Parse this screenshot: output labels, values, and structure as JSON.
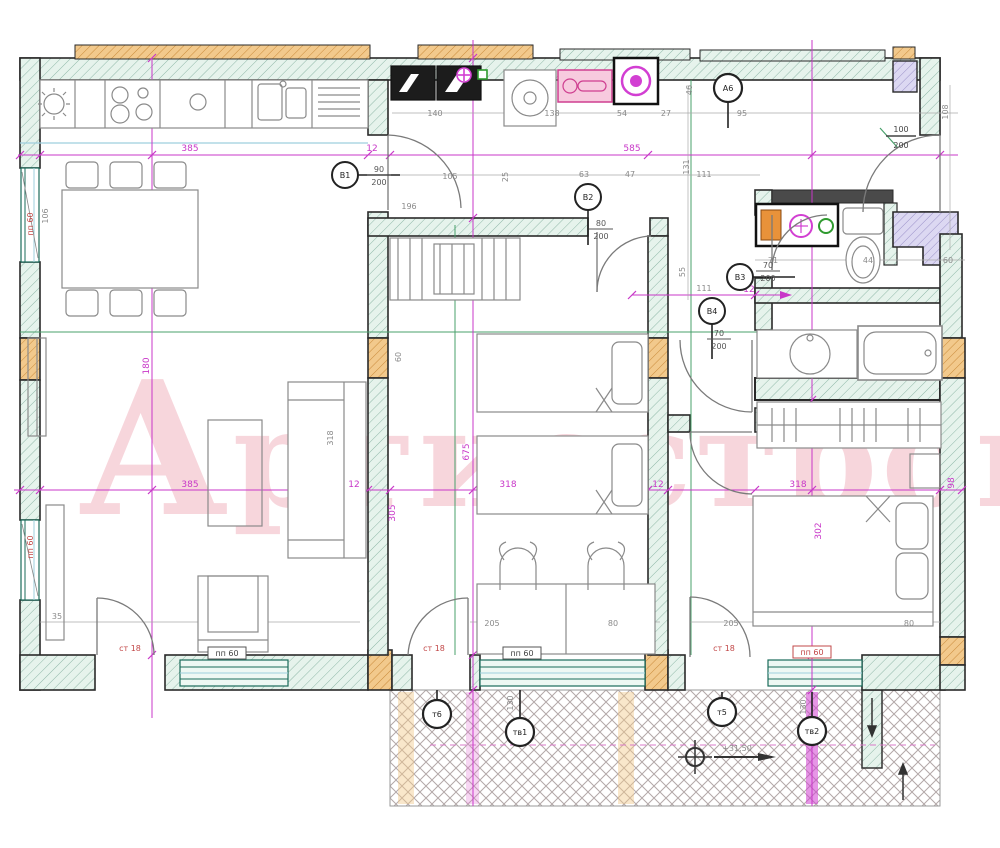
{
  "meta": {
    "drawing_type": "apartment floor plan",
    "style": "CAD blueprint with axis grid"
  },
  "watermark": {
    "first": "А",
    "rest": "ртисстрой",
    "color": "#e8889c"
  },
  "colors": {
    "axis_magenta": "#c837c8",
    "wall_teal": "#e6f3ec",
    "hatch_teal": "#8fb8a8",
    "column_orange": "#f2c98c",
    "corner_lavender": "#dcd8f2",
    "guide_green": "#49a06b",
    "guide_cyan": "#9ecfdd",
    "fixture_orange": "#e8923a",
    "fixture_green": "#2f9a2f",
    "appliance_pink": "#f7cade"
  },
  "dims": [
    {
      "t": "140",
      "x": 435,
      "y": 116,
      "c": "dim"
    },
    {
      "t": "138",
      "x": 552,
      "y": 116,
      "c": "dim"
    },
    {
      "t": "54",
      "x": 622,
      "y": 116,
      "c": "dim"
    },
    {
      "t": "27",
      "x": 666,
      "y": 116,
      "c": "dim"
    },
    {
      "t": "95",
      "x": 742,
      "y": 116,
      "c": "dim"
    },
    {
      "t": "46",
      "x": 692,
      "y": 90,
      "c": "dim",
      "rot": -90
    },
    {
      "t": "108",
      "x": 948,
      "y": 112,
      "c": "dim",
      "rot": -90
    },
    {
      "t": "106",
      "x": 48,
      "y": 216,
      "c": "dim",
      "rot": -90
    },
    {
      "t": "пп 60",
      "x": 33,
      "y": 224,
      "c": "dim-red",
      "rot": -90
    },
    {
      "t": "пп 60",
      "x": 33,
      "y": 547,
      "c": "dim-red",
      "rot": -90
    },
    {
      "t": "105",
      "x": 450,
      "y": 179,
      "c": "dim"
    },
    {
      "t": "25",
      "x": 508,
      "y": 177,
      "c": "dim",
      "rot": -90
    },
    {
      "t": "63",
      "x": 584,
      "y": 177,
      "c": "dim"
    },
    {
      "t": "47",
      "x": 630,
      "y": 177,
      "c": "dim"
    },
    {
      "t": "131",
      "x": 689,
      "y": 167,
      "c": "dim",
      "rot": -90
    },
    {
      "t": "111",
      "x": 704,
      "y": 177,
      "c": "dim"
    },
    {
      "t": "196",
      "x": 409,
      "y": 209,
      "c": "dim"
    },
    {
      "t": "71",
      "x": 773,
      "y": 263,
      "c": "dim"
    },
    {
      "t": "44",
      "x": 868,
      "y": 263,
      "c": "dim"
    },
    {
      "t": "60",
      "x": 948,
      "y": 263,
      "c": "dim"
    },
    {
      "t": "55",
      "x": 685,
      "y": 272,
      "c": "dim",
      "rot": -90
    },
    {
      "t": "111",
      "x": 704,
      "y": 291,
      "c": "dim"
    },
    {
      "t": "60",
      "x": 401,
      "y": 357,
      "c": "dim",
      "rot": -90
    },
    {
      "t": "318",
      "x": 333,
      "y": 438,
      "c": "dim",
      "rot": -90
    },
    {
      "t": "35",
      "x": 57,
      "y": 619,
      "c": "dim"
    },
    {
      "t": "205",
      "x": 492,
      "y": 626,
      "c": "dim"
    },
    {
      "t": "80",
      "x": 613,
      "y": 626,
      "c": "dim"
    },
    {
      "t": "205",
      "x": 731,
      "y": 626,
      "c": "dim"
    },
    {
      "t": "80",
      "x": 909,
      "y": 626,
      "c": "dim"
    },
    {
      "t": "130",
      "x": 513,
      "y": 703,
      "c": "dim",
      "rot": -90
    },
    {
      "t": "130",
      "x": 806,
      "y": 707,
      "c": "dim",
      "rot": -90
    },
    {
      "t": "385",
      "x": 190,
      "y": 151,
      "c": "dim-mag"
    },
    {
      "t": "12",
      "x": 372,
      "y": 151,
      "c": "dim-mag"
    },
    {
      "t": "585",
      "x": 632,
      "y": 151,
      "c": "dim-mag"
    },
    {
      "t": "385",
      "x": 190,
      "y": 487,
      "c": "dim-mag"
    },
    {
      "t": "12",
      "x": 354,
      "y": 487,
      "c": "dim-mag"
    },
    {
      "t": "318",
      "x": 508,
      "y": 487,
      "c": "dim-mag"
    },
    {
      "t": "12",
      "x": 658,
      "y": 487,
      "c": "dim-mag"
    },
    {
      "t": "318",
      "x": 798,
      "y": 487,
      "c": "dim-mag"
    },
    {
      "t": "98",
      "x": 954,
      "y": 483,
      "c": "dim-mag",
      "rot": -90
    },
    {
      "t": "180",
      "x": 149,
      "y": 366,
      "c": "dim-mag",
      "rot": -90
    },
    {
      "t": "675",
      "x": 469,
      "y": 452,
      "c": "dim-mag",
      "rot": -90
    },
    {
      "t": "305",
      "x": 395,
      "y": 513,
      "c": "dim-mag",
      "rot": -90
    },
    {
      "t": "302",
      "x": 821,
      "y": 531,
      "c": "dim-mag",
      "rot": -90
    },
    {
      "t": "12",
      "x": 749,
      "y": 292,
      "c": "dim-mag"
    },
    {
      "t": "ст 18",
      "x": 130,
      "y": 651,
      "c": "dim-red"
    },
    {
      "t": "ст 18",
      "x": 434,
      "y": 651,
      "c": "dim-red"
    },
    {
      "t": "ст 18",
      "x": 724,
      "y": 651,
      "c": "dim-red"
    },
    {
      "t": "пп 60",
      "x": 227,
      "y": 656,
      "c": "dim-dark",
      "box": "dark"
    },
    {
      "t": "пп 60",
      "x": 522,
      "y": 656,
      "c": "dim-dark",
      "box": "dark"
    },
    {
      "t": "пп 60",
      "x": 812,
      "y": 655,
      "c": "dim-red",
      "box": "red"
    }
  ],
  "door_markers": [
    {
      "label": "В1",
      "x": 345,
      "y": 175,
      "num": "90",
      "den": "200",
      "fx": 379,
      "fy": 172,
      "stem": "right"
    },
    {
      "label": "В2",
      "x": 588,
      "y": 197,
      "num": "80",
      "den": "200",
      "fx": 601,
      "fy": 226,
      "stem": "down"
    },
    {
      "label": "В3",
      "x": 740,
      "y": 277,
      "num": "70",
      "den": "200",
      "fx": 768,
      "fy": 268,
      "stem": "right"
    },
    {
      "label": "В4",
      "x": 712,
      "y": 311,
      "num": "70",
      "den": "200",
      "fx": 719,
      "fy": 336,
      "stem": "down"
    }
  ],
  "entrance_door": {
    "num": "100",
    "den": "200",
    "x": 901,
    "y": 132
  },
  "bubbles": [
    {
      "label": "А6",
      "x": 728,
      "y": 88,
      "stem_y2": 128
    },
    {
      "label": "т6",
      "x": 437,
      "y": 714,
      "stem_y1": 690
    },
    {
      "label": "тв1",
      "x": 520,
      "y": 732,
      "stem_y1": 690
    },
    {
      "label": "т5",
      "x": 722,
      "y": 712,
      "stem_y1": 692
    },
    {
      "label": "тв2",
      "x": 812,
      "y": 731,
      "stem_y1": 692
    }
  ],
  "terrace": {
    "elevation": "+31,50"
  }
}
